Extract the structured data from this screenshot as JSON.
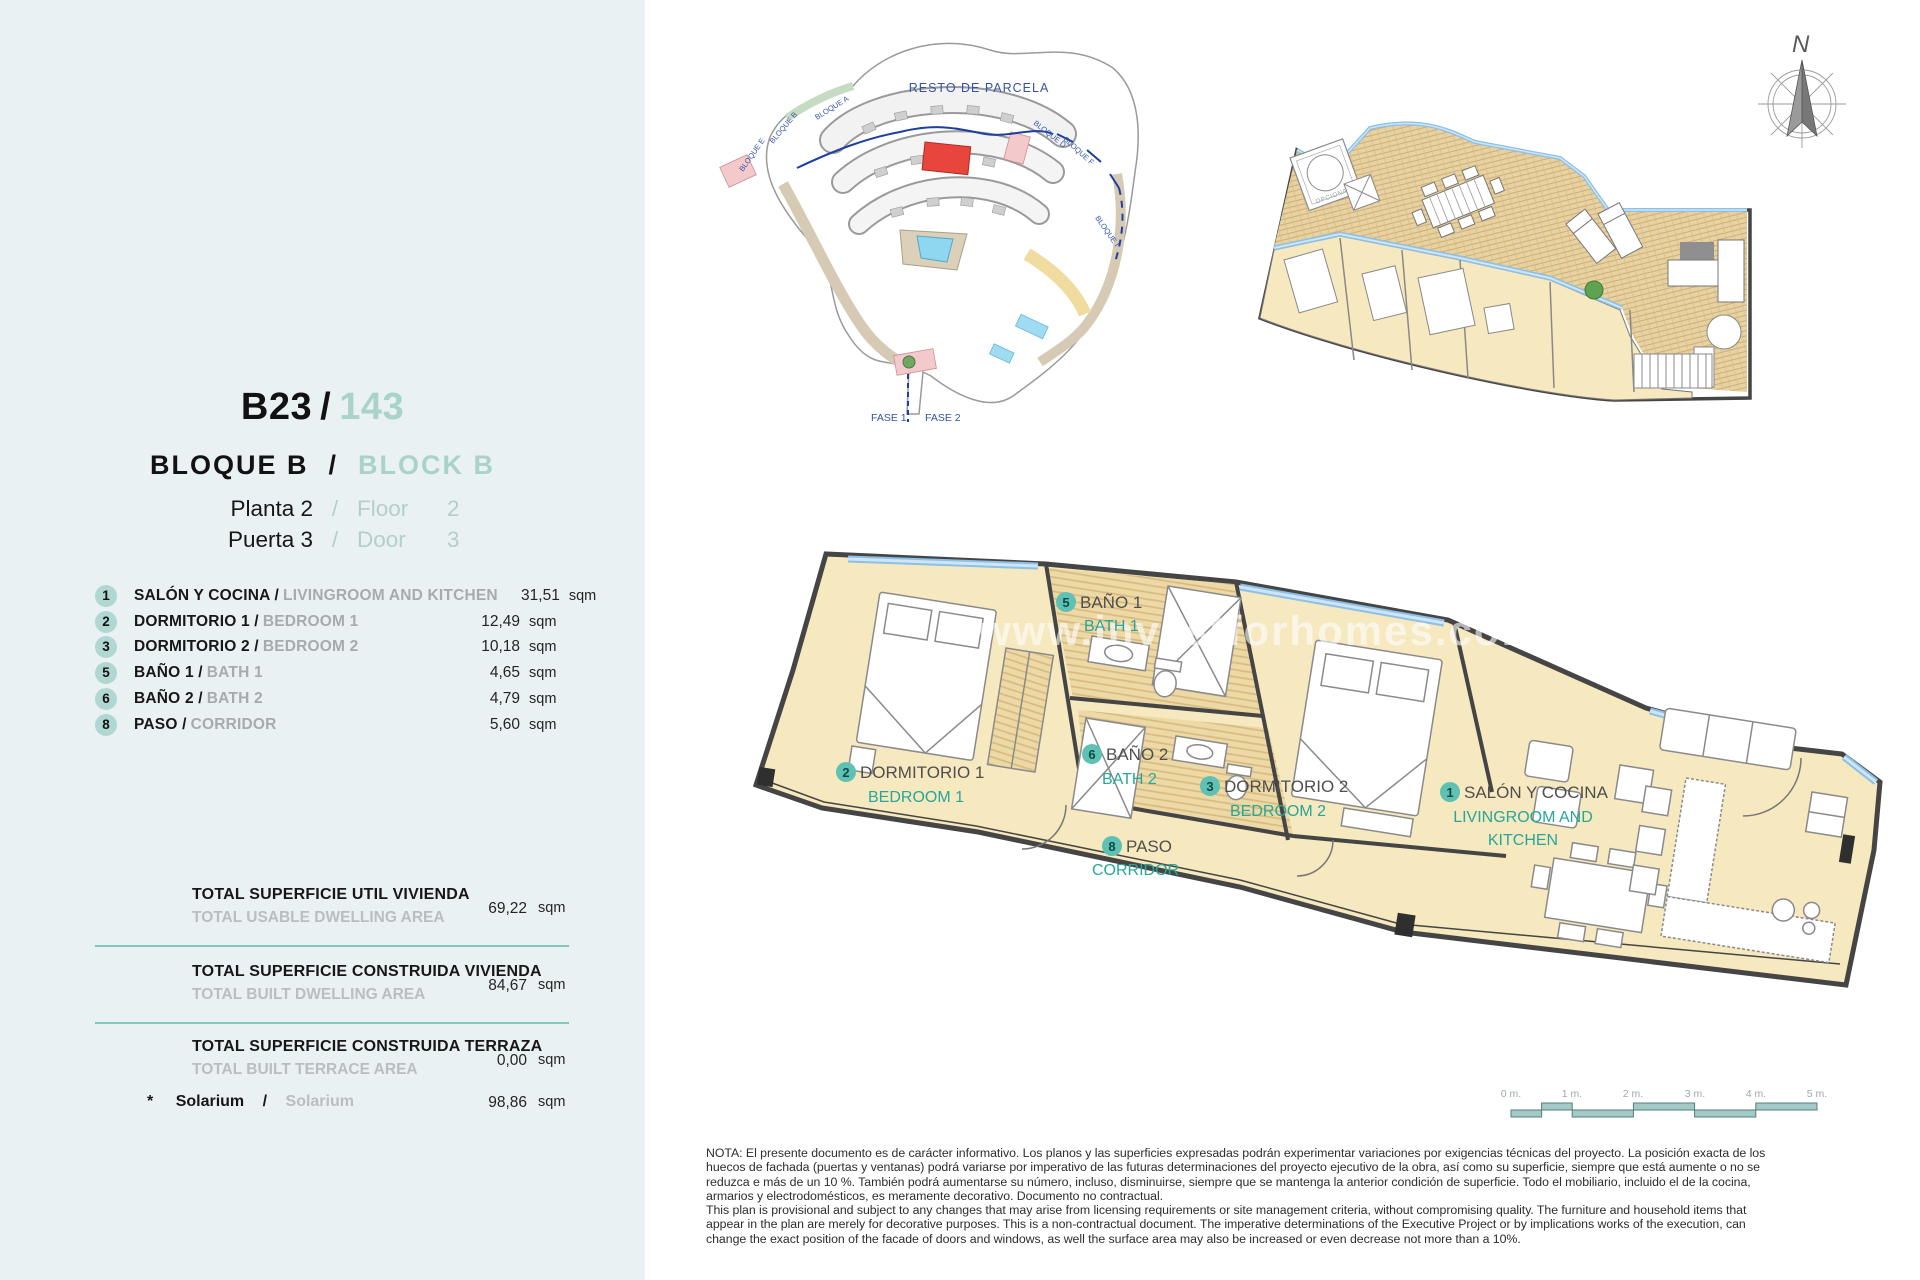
{
  "colors": {
    "panel_bg": "#eaf1f3",
    "accent_teal": "#26a79a",
    "light_teal": "#a9d2ca",
    "circle_teal": "#b0d7d1",
    "divider_teal": "#86c5be",
    "room_yellow": "#f6e8bf",
    "bath_tan": "#ecd9a6",
    "wall_grey": "#454545",
    "glazing_blue": "#8cc0e6",
    "site_red": "#e8463c",
    "site_pink": "#f4c9cc",
    "site_blue": "#3353a8",
    "scale_teal": "#a3cac8",
    "muted_grey": "#a6abad"
  },
  "unit": {
    "code": "B23",
    "slash": "/",
    "number": "143"
  },
  "block": {
    "es": "BLOQUE B",
    "sep": "/",
    "en": "BLOCK B"
  },
  "floor": {
    "es": "Planta 2",
    "sep": "/",
    "en_label": "Floor",
    "en_value": "2"
  },
  "door": {
    "es": "Puerta 3",
    "sep": "/",
    "en_label": "Door",
    "en_value": "3"
  },
  "rooms": [
    {
      "num": "1",
      "es": "SALÓN Y COCINA /",
      "en": "LIVINGROOM AND KITCHEN",
      "area": "31,51",
      "unit": "sqm"
    },
    {
      "num": "2",
      "es": "DORMITORIO 1 /",
      "en": "BEDROOM 1",
      "area": "12,49",
      "unit": "sqm"
    },
    {
      "num": "3",
      "es": "DORMITORIO 2 /",
      "en": "BEDROOM 2",
      "area": "10,18",
      "unit": "sqm"
    },
    {
      "num": "5",
      "es": "BAÑO 1 /",
      "en": "BATH 1",
      "area": "4,65",
      "unit": "sqm"
    },
    {
      "num": "6",
      "es": "BAÑO 2 /",
      "en": "BATH 2",
      "area": "4,79",
      "unit": "sqm"
    },
    {
      "num": "8",
      "es": "PASO /",
      "en": "CORRIDOR",
      "area": "5,60",
      "unit": "sqm"
    }
  ],
  "totals": [
    {
      "es": "TOTAL SUPERFICIE UTIL VIVIENDA",
      "en": "TOTAL USABLE DWELLING AREA",
      "value": "69,22",
      "unit": "sqm"
    },
    {
      "es": "TOTAL SUPERFICIE CONSTRUIDA VIVIENDA",
      "en": "TOTAL BUILT DWELLING AREA",
      "value": "84,67",
      "unit": "sqm"
    },
    {
      "es": "TOTAL SUPERFICIE CONSTRUIDA TERRAZA",
      "en": "TOTAL BUILT TERRACE AREA",
      "value": "0,00",
      "unit": "sqm"
    }
  ],
  "solarium": {
    "star": "*",
    "es": "Solarium",
    "sep": "/",
    "en": "Solarium",
    "value": "98,86",
    "unit": "sqm"
  },
  "site_plan": {
    "resto": "RESTO DE PARCELA",
    "fase1": "FASE 1",
    "fase2": "FASE 2",
    "bloque_a": "BLOQUE A",
    "bloque_b": "BLOQUE B",
    "bloque_e": "BLOQUE E",
    "bloque_d": "BLOQUE D",
    "bloque_f": "BLOQUE F",
    "bloque_i": "BLOQUE I"
  },
  "plan_labels": {
    "salon": {
      "num": "1",
      "es": "SALÓN Y COCINA",
      "en1": "LIVINGROOM AND",
      "en2": "KITCHEN"
    },
    "bedroom1": {
      "num": "2",
      "es": "DORMITORIO 1",
      "en": "BEDROOM 1"
    },
    "bedroom2": {
      "num": "3",
      "es": "DORMITORIO 2",
      "en": "BEDROOM 2"
    },
    "bath1": {
      "num": "5",
      "es": "BAÑO 1",
      "en": "BATH 1"
    },
    "bath2": {
      "num": "6",
      "es": "BAÑO 2",
      "en": "BATH 2"
    },
    "corridor": {
      "num": "8",
      "es": "PASO",
      "en": "CORRIDOR"
    }
  },
  "roof_plan": {
    "opcional": "OPCIONAL"
  },
  "compass": {
    "north": "N"
  },
  "scale_bar": {
    "m0": "0 m.",
    "m1": "1 m.",
    "m2": "2 m.",
    "m3": "3 m.",
    "m4": "4 m.",
    "m5": "5 m."
  },
  "watermark": "www.investforhomes.com",
  "note": {
    "es1": "NOTA: El presente documento es de carácter informativo. Los planos y las superficies expresadas podrán experimentar variaciones por exigencias técnicas del proyecto. La posición exacta de los",
    "es2": "huecos de fachada (puertas y ventanas) podrá variarse por imperativo de las futuras determinaciones del proyecto ejecutivo de la obra, así como su superficie, siempre que está aumente o no se",
    "es3": "reduzca e más de un 10 %. También podrá aumentarse su número, incluso, disminuirse, siempre que se mantenga la anterior condición de superficie. Todo el mobiliario, incluido el de la cocina,",
    "es4": "armarios y electrodomésticos, es meramente decorativo. Documento no contractual.",
    "en1": "This plan is provisional and subject to any changes that may arise from licensing requirements or site management criteria, without compromising quality. The furniture and household items that",
    "en2": "appear in the plan are merely for decorative purposes. This is a non-contractual document. The imperative determinations of the Executive Project or by implications works of the execution, can",
    "en3": "change the exact position of the facade of doors and windows, as well the surface area may also be increased or even decrease not more than a 10%."
  }
}
